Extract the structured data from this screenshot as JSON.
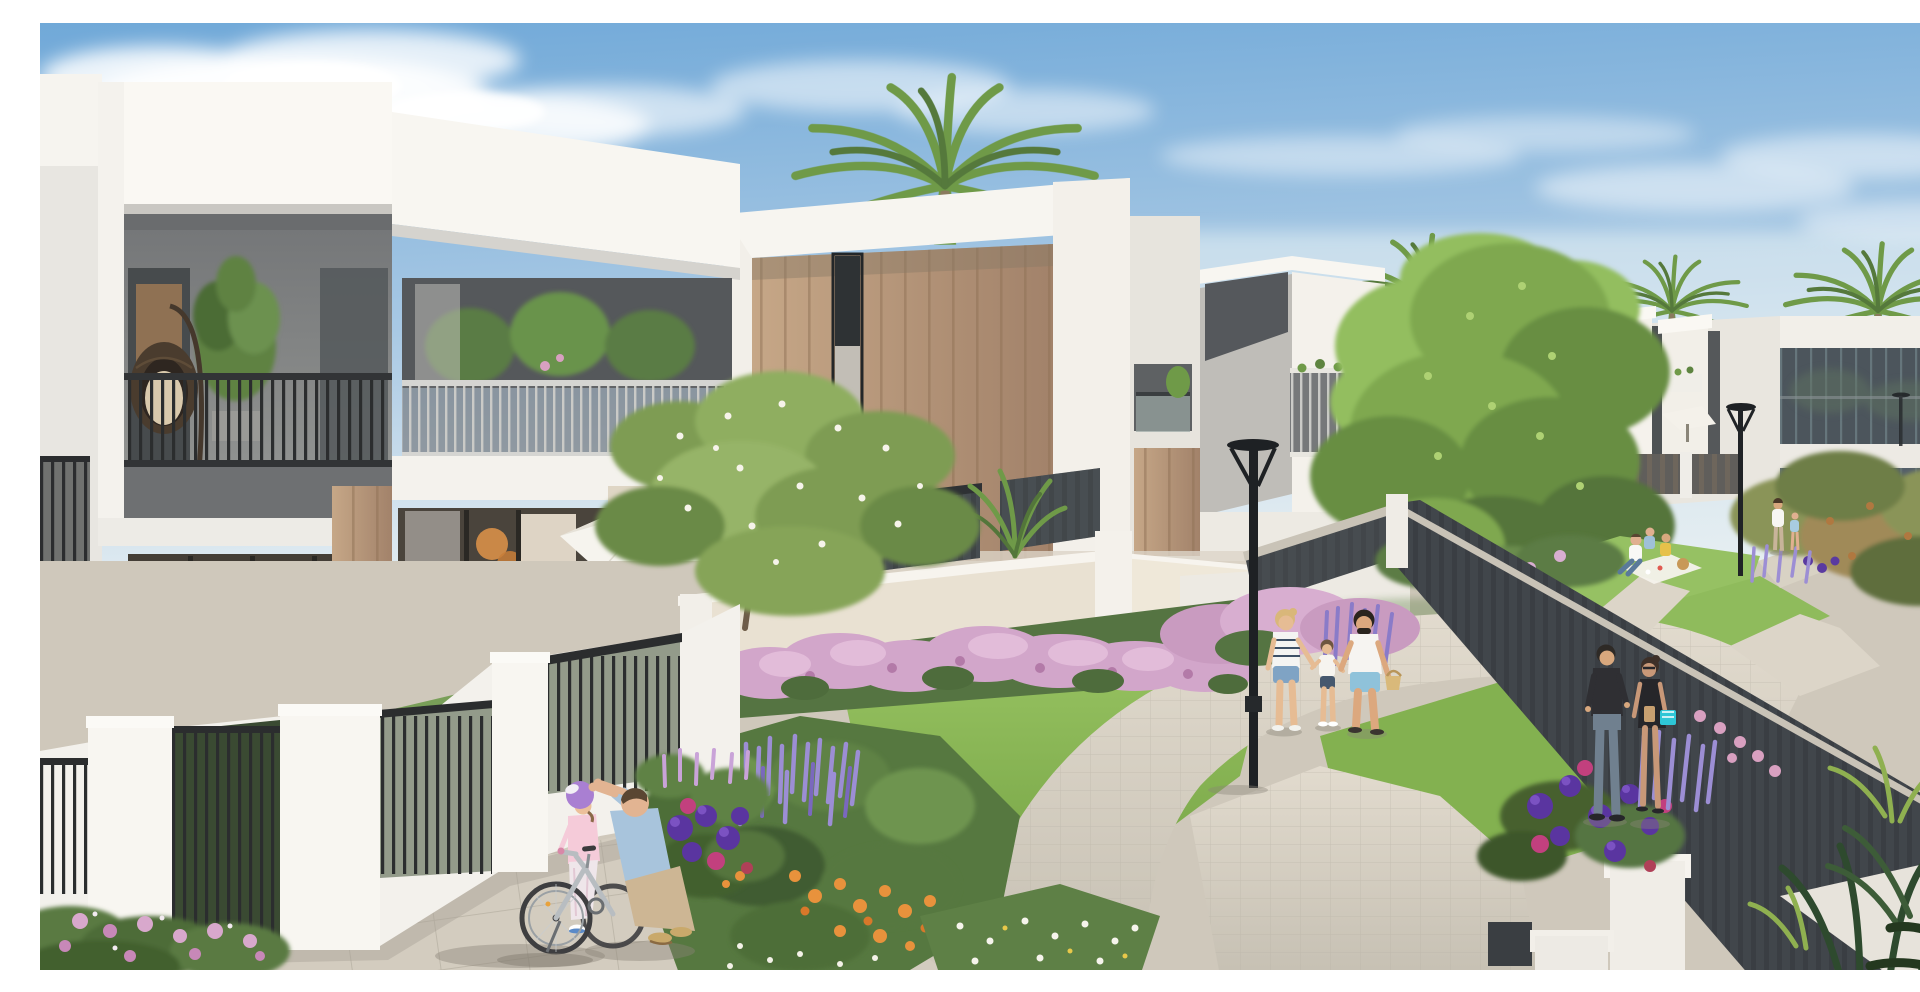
{
  "scene": {
    "type": "architectural-render",
    "description": "Sunny 3D architectural rendering of a modern townhouse community: white cubic villas with wood accents and recessed balconies, landscaped communal gardens full of purple and pink flowers, winding paver walkways, palm trees and residents strolling",
    "sky": "blue sky with soft white clouds",
    "lighting": "bright daylight, sun from upper right"
  },
  "buildings": {
    "left_villa": {
      "style": "white two-story villa with gray recessed balcony",
      "balcony_items": [
        "hanging egg chair",
        "potted plant",
        "black vertical railing"
      ],
      "ground_floor": "glass sliding doors with warm lit interior, banana plant, beige sofa"
    },
    "terrace": {
      "items": [
        "white parasol",
        "lounge cushions"
      ]
    },
    "wood_villa": {
      "style": "white parapet frame with wood-slat facade",
      "feature": "narrow dark slot window"
    },
    "row_villas": "receding white cubic villas with angular dark balcony recesses and planter balconies",
    "far_building": "long two-story building with dark ribbon glazing and glass ground floor",
    "garden_walls": "white stucco walls with black metal railings and entry gates"
  },
  "vegetation": {
    "palm_trees": 4,
    "big_green_tree": "large leafy tree mid-right",
    "frangipani_tree": "blossoming tree in front of wood villa",
    "flowers": [
      "lavender spikes",
      "pink bougainvillea bushes",
      "purple dahlias",
      "magenta roses",
      "orange blooms",
      "white daisies"
    ],
    "corner_plants": "dark tropical fan palms bottom right"
  },
  "people": [
    {
      "group": "father-helping-girl",
      "members": 2,
      "details": "man in light blue shirt kneeling, adjusting purple helmet of girl in pink beside a silver kids bicycle"
    },
    {
      "group": "family-walking",
      "members": 3,
      "details": "mother in striped top and denim shorts, child in white, father in white tee and blue shorts carrying a basket"
    },
    {
      "group": "couple-standing",
      "members": 2,
      "details": "man in black top and jeans talking with woman in black dress holding a teal bag"
    },
    {
      "group": "picnic-group",
      "members": 3,
      "details": "sitting on a white blanket on the lawn"
    },
    {
      "group": "distant-walkers",
      "members": 2,
      "details": "adult in white with child near far building"
    }
  ],
  "objects": [
    "street lamp",
    "parasol",
    "garden gate",
    "black metal railings",
    "dark slat privacy fence",
    "paver pathways",
    "bicycle"
  ],
  "colors": {
    "sky_top": "#6FA8D8",
    "sky_mid": "#A9C9E4",
    "sky_horizon": "#DDE9F0",
    "cloud": "#FFFFFF",
    "wall_white": "#FAF8F3",
    "wall_shadow": "#D8D6D1",
    "facade_gray": "#8E908E",
    "wood": "#A2826A",
    "wood_light": "#C6A787",
    "glass_dark": "#3E4244",
    "interior_glow": "#D8A868",
    "railing_black": "#2B2D2E",
    "fence": "#3A3E43",
    "fence_cap": "#C9C3B7",
    "lawn": "#74A244",
    "lawn_light": "#9CC765",
    "foliage": "#6F9A48",
    "foliage_dark": "#54743A",
    "palm_green": "#6F9A48",
    "lavender": "#9C8ED4",
    "pink_bloom": "#D2A6CA",
    "dahlia_purple": "#5A35A0",
    "magenta": "#C2407E",
    "orange_bloom": "#E8923C",
    "path": "#C6C0B3",
    "path_light": "#E2DBCE",
    "paver_line": "#AFA99C",
    "lamp": "#1E2124",
    "skin": "#E2B492",
    "teal_bag": "#2EC6D6"
  }
}
